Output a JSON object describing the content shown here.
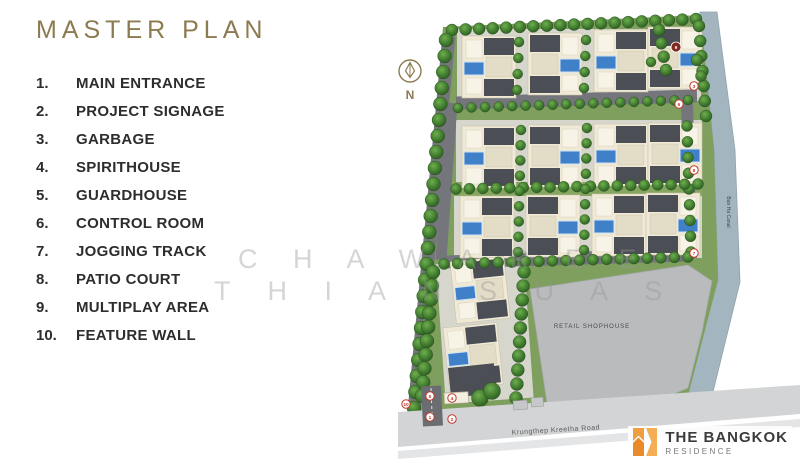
{
  "title": "MASTER PLAN",
  "colors": {
    "accent": "#8c7b50",
    "marker_red": "#c0392b",
    "pool_blue": "#3f80c8",
    "canal": "#a3b6c0",
    "logo_orange": "#ee9a3c"
  },
  "legend": {
    "items": [
      {
        "num": "1.",
        "label": "MAIN ENTRANCE"
      },
      {
        "num": "2.",
        "label": "PROJECT SIGNAGE"
      },
      {
        "num": "3.",
        "label": "GARBAGE"
      },
      {
        "num": "4.",
        "label": "SPIRITHOUSE"
      },
      {
        "num": "5.",
        "label": "GUARDHOUSE"
      },
      {
        "num": "6.",
        "label": "CONTROL ROOM"
      },
      {
        "num": "7.",
        "label": "JOGGING TRACK"
      },
      {
        "num": "8.",
        "label": "PATIO COURT"
      },
      {
        "num": "9.",
        "label": "MULTIPLAY AREA"
      },
      {
        "num": "10.",
        "label": "FEATURE WALL"
      }
    ]
  },
  "map": {
    "compass_label": "N",
    "canal_label": "Ban Ha Canal",
    "road_label": "Krungthep Kreetha Road",
    "retail_label": "RETAIL SHOPHOUSE",
    "markers": [
      {
        "n": "9"
      },
      {
        "n": "3"
      },
      {
        "n": "6"
      },
      {
        "n": "8"
      },
      {
        "n": "7"
      },
      {
        "n": "10"
      },
      {
        "n": "5"
      },
      {
        "n": "1"
      },
      {
        "n": "4"
      },
      {
        "n": "2"
      }
    ]
  },
  "watermark": {
    "line1": "C H A W A R E E",
    "line2": "T H I A N S U A S"
  },
  "logo": {
    "name": "THE BANGKOK",
    "sub": "RESIDENCE"
  }
}
